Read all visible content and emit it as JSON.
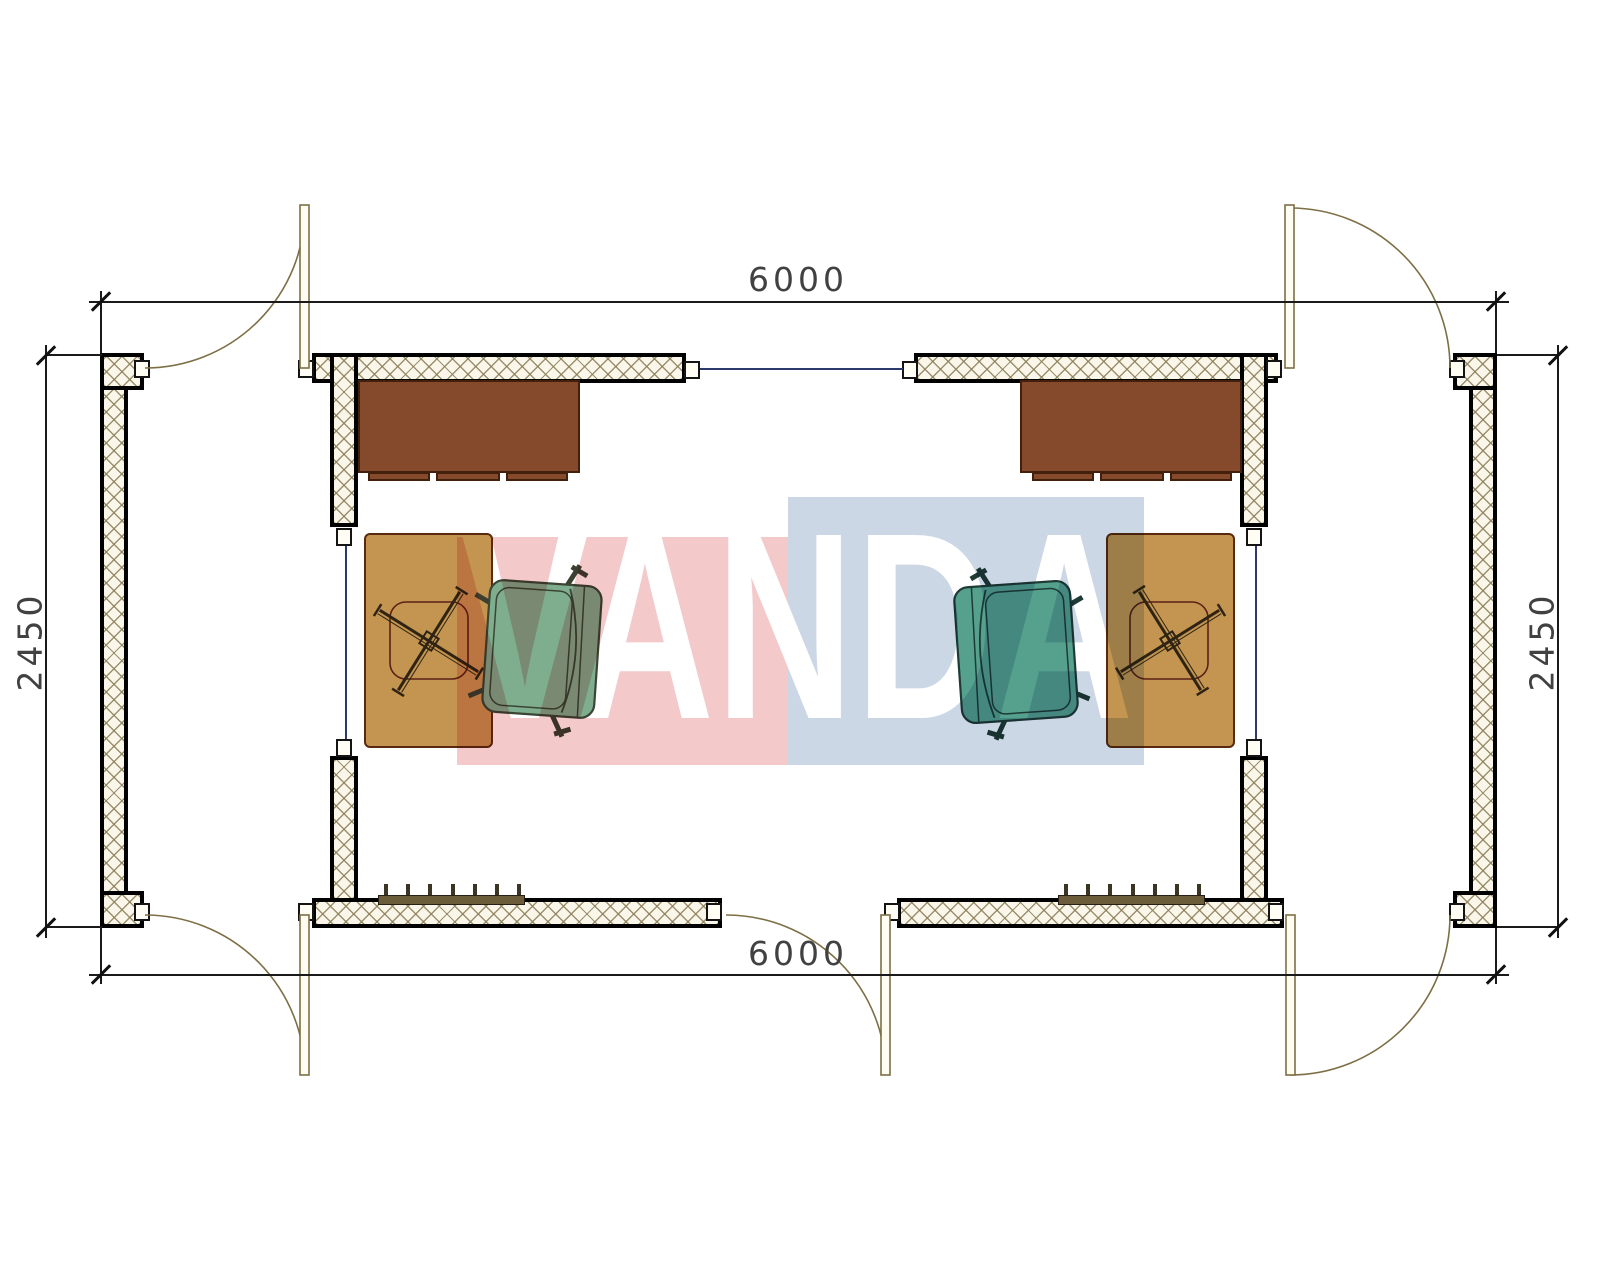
{
  "title": "Two-module cabin floor plan",
  "dimensions": {
    "top_width": "6000",
    "bottom_width": "6000",
    "left_height": "2450",
    "right_height": "2450"
  },
  "watermark": {
    "text": "VANDA",
    "pink_color": "#f4c9ca",
    "blue_color": "#ccd7e6"
  },
  "plan": {
    "wall_fill": "#faf6ea",
    "wall_hatch_color": "#8b7f58",
    "wall_border_color": "#000000",
    "window_line_color": "#2b3a6a",
    "door_line_color": "#7d6f45",
    "desk_color": "#854a2b",
    "table_color": "#c49550",
    "seat_outline_color": "#5c2018",
    "chair_cross_color": "#2f2413",
    "armchair_left_color": "#7fae8e",
    "armchair_right_color": "#55a18e",
    "radiator_color": "#6b5c3a",
    "radiator_tick_count": 7
  }
}
